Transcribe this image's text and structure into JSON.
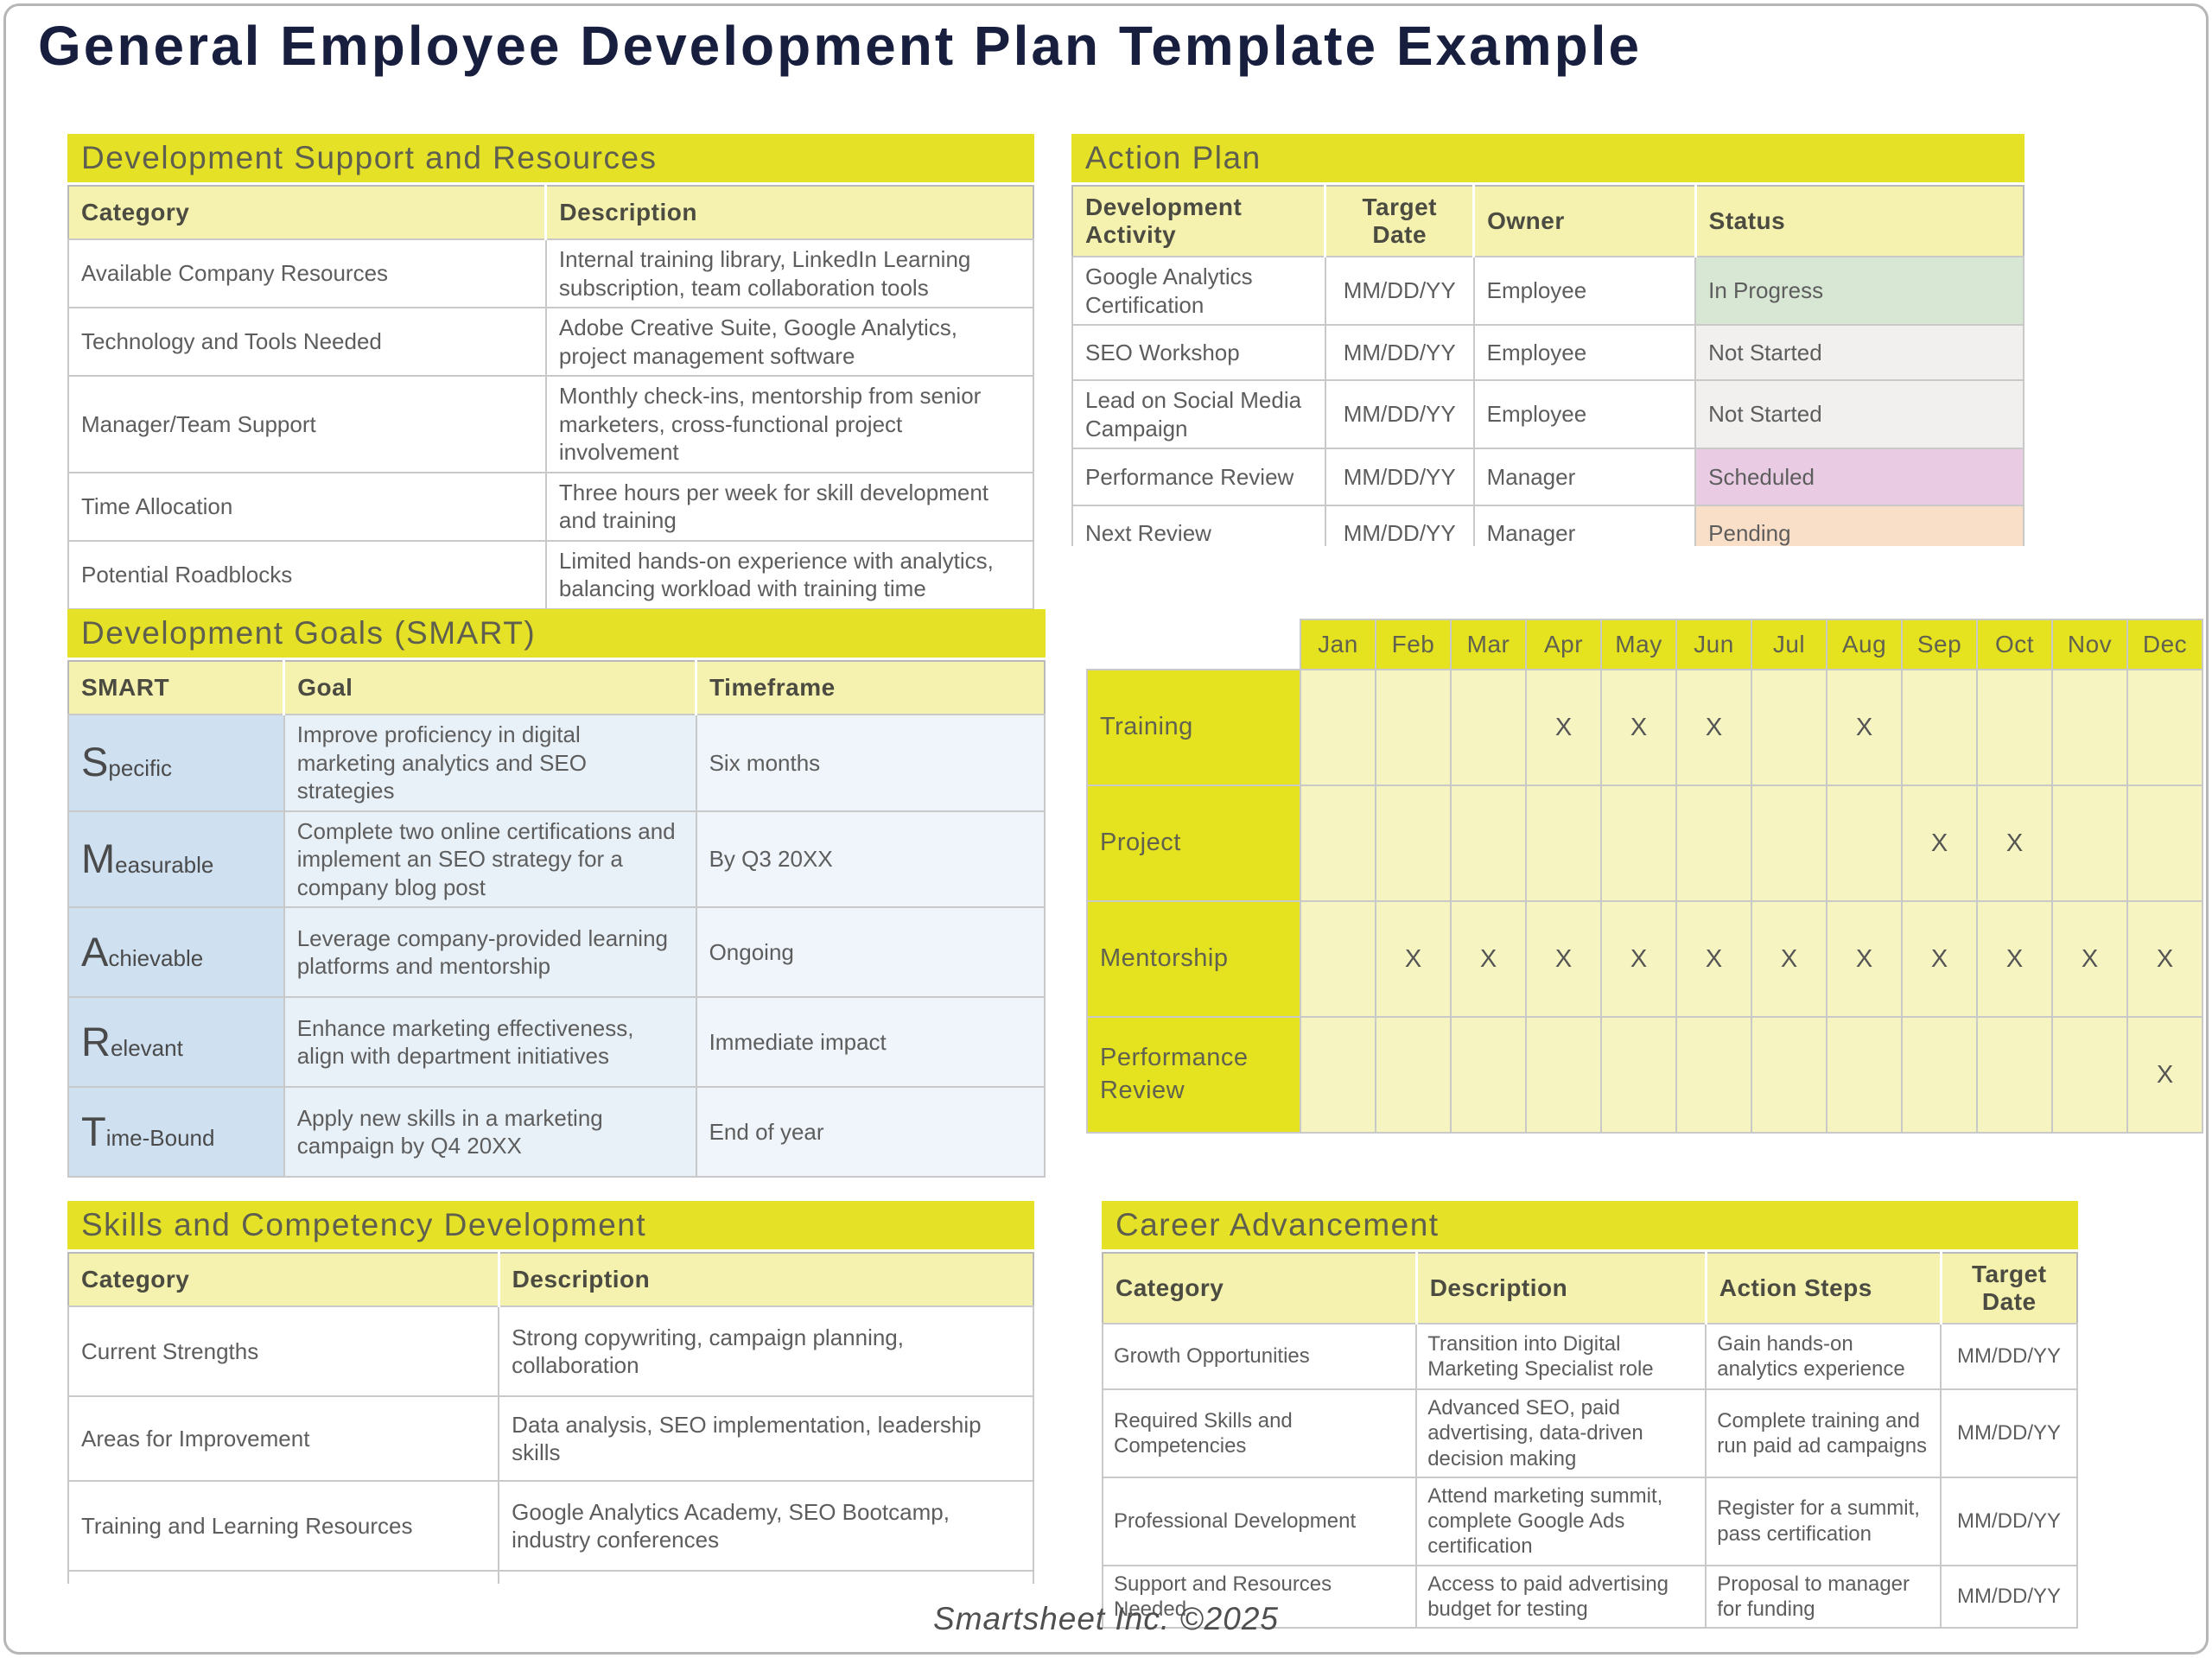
{
  "page_title": "General Employee Development Plan Template Example",
  "footer": "Smartsheet Inc. ©2025",
  "theme": {
    "title_bar_bg": "#e5e126",
    "column_header_bg": "#f4f2ae",
    "matrix_header_bg": "#e5e21f",
    "matrix_cell_bg": "#f6f4c0",
    "smart_label_bg": "#cfe0f1",
    "smart_goal_bg": "#e9f1f8",
    "smart_timeframe_bg": "#eff5fa",
    "status_in_progress": "#d8e6d4",
    "status_not_started": "#f1f0ef",
    "status_scheduled": "#e9cce4",
    "status_pending": "#fadfc8",
    "title_color": "#171e3e",
    "body_text": "#5d5d5d",
    "grid_line": "#c9c9c9"
  },
  "support": {
    "title": "Development Support and Resources",
    "headers": [
      "Category",
      "Description"
    ],
    "rows": [
      {
        "category": "Available Company Resources",
        "description": "Internal training library, LinkedIn Learning subscription, team collaboration tools"
      },
      {
        "category": "Technology and Tools Needed",
        "description": "Adobe Creative Suite, Google Analytics, project management software"
      },
      {
        "category": "Manager/Team Support",
        "description": "Monthly check-ins, mentorship from senior marketers, cross-functional project involvement"
      },
      {
        "category": "Time Allocation",
        "description": "Three hours per week for skill development and training"
      },
      {
        "category": "Potential Roadblocks",
        "description": "Limited hands-on experience with analytics, balancing workload with training time"
      }
    ]
  },
  "action": {
    "title": "Action Plan",
    "headers": [
      "Development Activity",
      "Target Date",
      "Owner",
      "Status"
    ],
    "rows": [
      {
        "activity": "Google Analytics Certification",
        "target_date": "MM/DD/YY",
        "owner": "Employee",
        "status": "In Progress",
        "status_color": "#d8e6d4"
      },
      {
        "activity": "SEO Workshop",
        "target_date": "MM/DD/YY",
        "owner": "Employee",
        "status": "Not Started",
        "status_color": "#f1f0ef"
      },
      {
        "activity": "Lead on Social Media Campaign",
        "target_date": "MM/DD/YY",
        "owner": "Employee",
        "status": "Not Started",
        "status_color": "#f1f0ef"
      },
      {
        "activity": "Performance Review",
        "target_date": "MM/DD/YY",
        "owner": "Manager",
        "status": "Scheduled",
        "status_color": "#e9cce4"
      },
      {
        "activity": "Next Review",
        "target_date": "MM/DD/YY",
        "owner": "Manager",
        "status": "Pending",
        "status_color": "#fadfc8"
      }
    ]
  },
  "smart": {
    "title": "Development Goals (SMART)",
    "headers": [
      "SMART",
      "Goal",
      "Timeframe"
    ],
    "rows": [
      {
        "letter": "S",
        "rest": "pecific",
        "goal": "Improve proficiency in digital marketing analytics and SEO strategies",
        "timeframe": "Six months"
      },
      {
        "letter": "M",
        "rest": "easurable",
        "goal": "Complete two online certifications and implement an SEO strategy for a company blog post",
        "timeframe": "By Q3 20XX"
      },
      {
        "letter": "A",
        "rest": "chievable",
        "goal": "Leverage company-provided learning platforms and mentorship",
        "timeframe": "Ongoing"
      },
      {
        "letter": "R",
        "rest": "elevant",
        "goal": "Enhance marketing effectiveness, align with department initiatives",
        "timeframe": "Immediate impact"
      },
      {
        "letter": "T",
        "rest": "ime-Bound",
        "goal": "Apply new skills in a marketing campaign by Q4 20XX",
        "timeframe": "End of year"
      }
    ]
  },
  "matrix": {
    "months": [
      "Jan",
      "Feb",
      "Mar",
      "Apr",
      "May",
      "Jun",
      "Jul",
      "Aug",
      "Sep",
      "Oct",
      "Nov",
      "Dec"
    ],
    "rows": [
      {
        "label": "Training",
        "cells": [
          "",
          "",
          "",
          "X",
          "X",
          "X",
          "",
          "X",
          "",
          "",
          "",
          ""
        ]
      },
      {
        "label": "Project",
        "cells": [
          "",
          "",
          "",
          "",
          "",
          "",
          "",
          "",
          "X",
          "X",
          "",
          ""
        ]
      },
      {
        "label": "Mentorship",
        "cells": [
          "",
          "X",
          "X",
          "X",
          "X",
          "X",
          "X",
          "X",
          "X",
          "X",
          "X",
          "X"
        ]
      },
      {
        "label": "Performance Review",
        "cells": [
          "",
          "",
          "",
          "",
          "",
          "",
          "",
          "",
          "",
          "",
          "",
          "X"
        ]
      }
    ]
  },
  "skills": {
    "title": "Skills and Competency Development",
    "headers": [
      "Category",
      "Description"
    ],
    "rows": [
      {
        "category": "Current Strengths",
        "description": "Strong copywriting, campaign planning, collaboration"
      },
      {
        "category": "Areas for Improvement",
        "description": "Data analysis, SEO implementation, leadership skills"
      },
      {
        "category": "Training and Learning Resources",
        "description": "Google Analytics Academy, SEO Bootcamp, industry conferences"
      }
    ]
  },
  "career": {
    "title": "Career Advancement",
    "headers": [
      "Category",
      "Description",
      "Action Steps",
      "Target Date"
    ],
    "rows": [
      {
        "category": "Growth Opportunities",
        "description": "Transition into Digital Marketing Specialist role",
        "action_steps": "Gain hands-on analytics experience",
        "target_date": "MM/DD/YY"
      },
      {
        "category": "Required Skills and Competencies",
        "description": "Advanced SEO, paid advertising, data-driven decision making",
        "action_steps": "Complete training and run paid ad campaigns",
        "target_date": "MM/DD/YY"
      },
      {
        "category": "Professional Development",
        "description": "Attend marketing summit, complete Google Ads certification",
        "action_steps": "Register for a summit, pass certification",
        "target_date": "MM/DD/YY"
      },
      {
        "category": "Support and Resources Needed",
        "description": "Access to paid advertising budget for testing",
        "action_steps": "Proposal to manager for funding",
        "target_date": "MM/DD/YY"
      }
    ]
  }
}
